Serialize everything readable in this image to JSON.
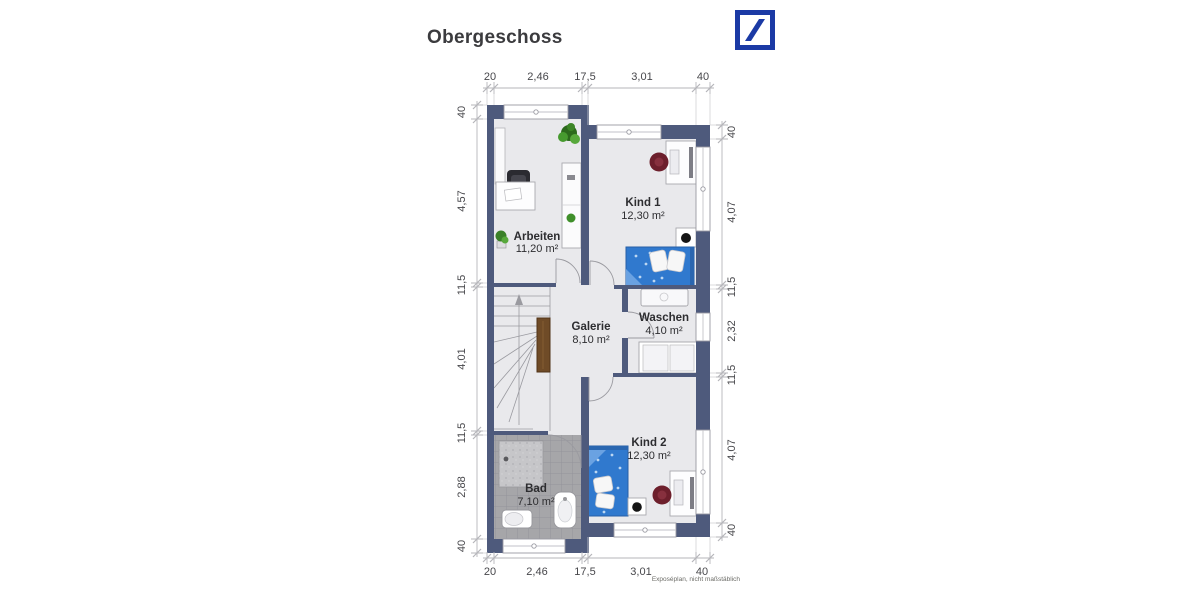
{
  "header": {
    "title": "Obergeschoss"
  },
  "rooms": [
    {
      "id": "arbeiten",
      "name": "Arbeiten",
      "area": "11,20 m²"
    },
    {
      "id": "kind1",
      "name": "Kind 1",
      "area": "12,30 m²"
    },
    {
      "id": "galerie",
      "name": "Galerie",
      "area": "8,10 m²"
    },
    {
      "id": "waschen",
      "name": "Waschen",
      "area": "4,10 m²"
    },
    {
      "id": "bad",
      "name": "Bad",
      "area": "7,10 m²"
    },
    {
      "id": "kind2",
      "name": "Kind 2",
      "area": "12,30 m²"
    }
  ],
  "dimensions": {
    "top": [
      "20",
      "2,46",
      "17,5",
      "3,01",
      "40"
    ],
    "bottom": [
      "20",
      "2,46",
      "17,5",
      "3,01",
      "40"
    ],
    "left": [
      "40",
      "4,57",
      "11,5",
      "4,01",
      "11,5",
      "2,88",
      "40"
    ],
    "right": [
      "40",
      "4,07",
      "11,5",
      "2,32",
      "11,5",
      "4,07",
      "40"
    ]
  },
  "footnote": "Exposéplan, nicht maßstäblich",
  "colors": {
    "wall": "#4e5a7c",
    "floor": "#e9e9ec",
    "bath_tile": "#a6a6a9",
    "bed_blue": "#3079ce",
    "wood_rail": "#6f4b27",
    "logo_blue": "#1b3aa5"
  }
}
